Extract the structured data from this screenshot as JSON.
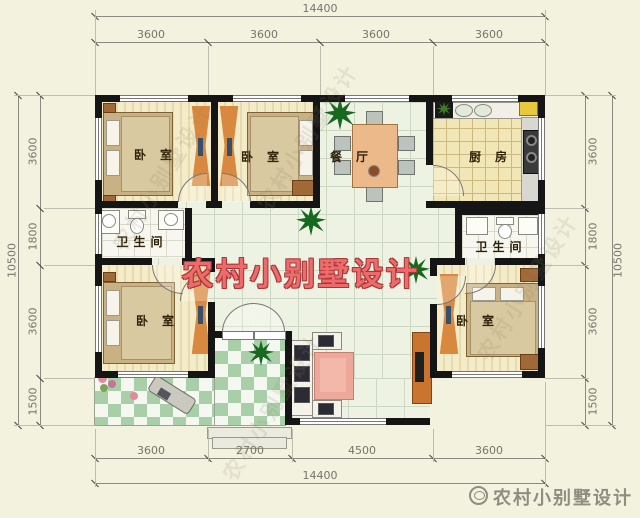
{
  "labels": {
    "bedroom": "卧室",
    "dining": "餐厅",
    "kitchen": "厨房",
    "bathroom": "卫生间"
  },
  "dims": {
    "top_total": "14400",
    "top": [
      "3600",
      "3600",
      "3600",
      "3600"
    ],
    "bottom_total": "14400",
    "bottom": [
      "3600",
      "2700",
      "4500",
      "3600"
    ],
    "left_total": "10500",
    "left": [
      "3600",
      "1800",
      "3600",
      "1500"
    ],
    "right_total": "10500",
    "right": [
      "3600",
      "1800",
      "3600",
      "1500"
    ]
  },
  "watermarks": {
    "center": "农村小别墅设计",
    "footer": "农村小别墅设计",
    "diagonal": "农村小别墅设计"
  },
  "colors": {
    "watermark_red": "#ef6a6a",
    "wall_black": "#151515",
    "wardrobe_orange": "#d8893f",
    "checker_green": "#a8cfa8",
    "rug_pink": "#eba89b"
  }
}
